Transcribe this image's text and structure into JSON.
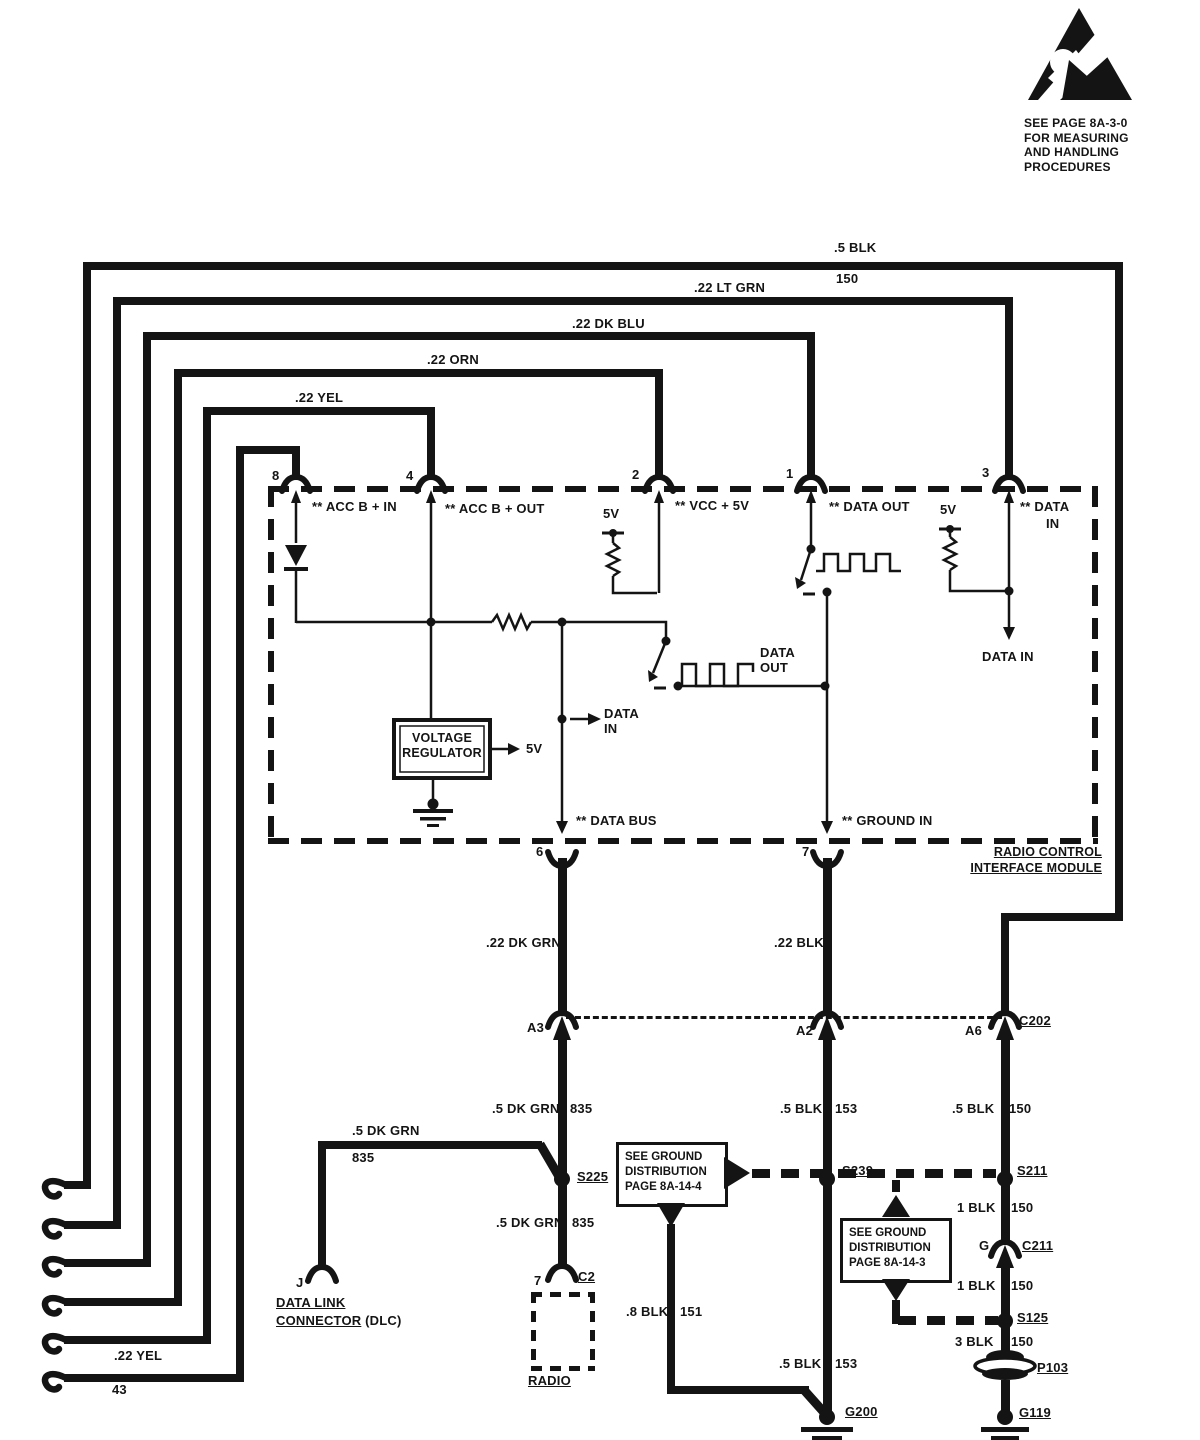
{
  "esd": {
    "lines": [
      "SEE PAGE 8A-3-0",
      "FOR MEASURING",
      "AND HANDLING",
      "PROCEDURES"
    ]
  },
  "loops": {
    "blk": {
      "color": ".5 BLK",
      "circuit": "150"
    },
    "ltgrn": ".22 LT GRN",
    "dkblu": ".22 DK BLU",
    "orn": ".22 ORN",
    "yel": ".22 YEL",
    "yel43": {
      "color": ".22 YEL",
      "circuit": "43"
    }
  },
  "module": {
    "name": [
      "RADIO CONTROL",
      "INTERFACE MODULE"
    ],
    "pins": {
      "p8": {
        "num": "8",
        "label": "** ACC B + IN"
      },
      "p4": {
        "num": "4",
        "label": "** ACC B + OUT"
      },
      "p2": {
        "num": "2",
        "label": "** VCC + 5V"
      },
      "p1": {
        "num": "1",
        "label": "** DATA OUT"
      },
      "p3": {
        "num": "3",
        "label1": "** DATA",
        "label2": "IN"
      },
      "p6": {
        "num": "6",
        "label": "** DATA BUS"
      },
      "p7": {
        "num": "7",
        "label": "** GROUND IN"
      }
    },
    "internal": {
      "vr": [
        "VOLTAGE",
        "REGULATOR"
      ],
      "vr_out": "5V",
      "pullup_vcc": "5V",
      "pullup_data": "5V",
      "data_in_mid": [
        "DATA",
        "IN"
      ],
      "data_out_mid": [
        "DATA",
        "OUT"
      ],
      "data_in_p3": "DATA IN"
    }
  },
  "harness": {
    "seg_dkgrn": ".22 DK GRN",
    "seg_blk": ".22 BLK",
    "c202": {
      "a3": "A3",
      "a2": "A2",
      "a6": "A6",
      "name": "C202"
    },
    "col_a3": {
      "color": ".5 DK GRN",
      "circuit": "835"
    },
    "col_a2": {
      "color": ".5 BLK",
      "circuit": "153"
    },
    "col_a6": {
      "color": ".5 BLK",
      "circuit": "150"
    },
    "s225": "S225",
    "s239": "S239",
    "s211": "S211",
    "a3_lower": {
      "color": ".5 DK GRN",
      "circuit": "835"
    },
    "g200_upper": {
      "color": ".8 BLK",
      "circuit": "151"
    },
    "g200_lower": {
      "color": ".5 BLK",
      "circuit": "153"
    },
    "r1": {
      "color": "1 BLK",
      "circuit": "150"
    },
    "r2": {
      "color": "1 BLK",
      "circuit": "150"
    },
    "r3": {
      "color": "3 BLK",
      "circuit": "150"
    }
  },
  "dlc": {
    "pin": "J",
    "color": ".5 DK GRN",
    "circuit": "835",
    "name1": "DATA LINK",
    "name2": "CONNECTOR",
    "suffix": " (DLC)"
  },
  "radio": {
    "pin": "7",
    "connector": "C2",
    "name": "RADIO"
  },
  "boxes": {
    "gd4": [
      "SEE GROUND",
      "DISTRIBUTION",
      "PAGE 8A-14-4"
    ],
    "gd3": [
      "SEE GROUND",
      "DISTRIBUTION",
      "PAGE 8A-14-3"
    ]
  },
  "grounds": {
    "g200": "G200",
    "g119": "G119"
  },
  "conns": {
    "c211_pin": "G",
    "c211": "C211",
    "s125": "S125",
    "p103": "P103"
  }
}
